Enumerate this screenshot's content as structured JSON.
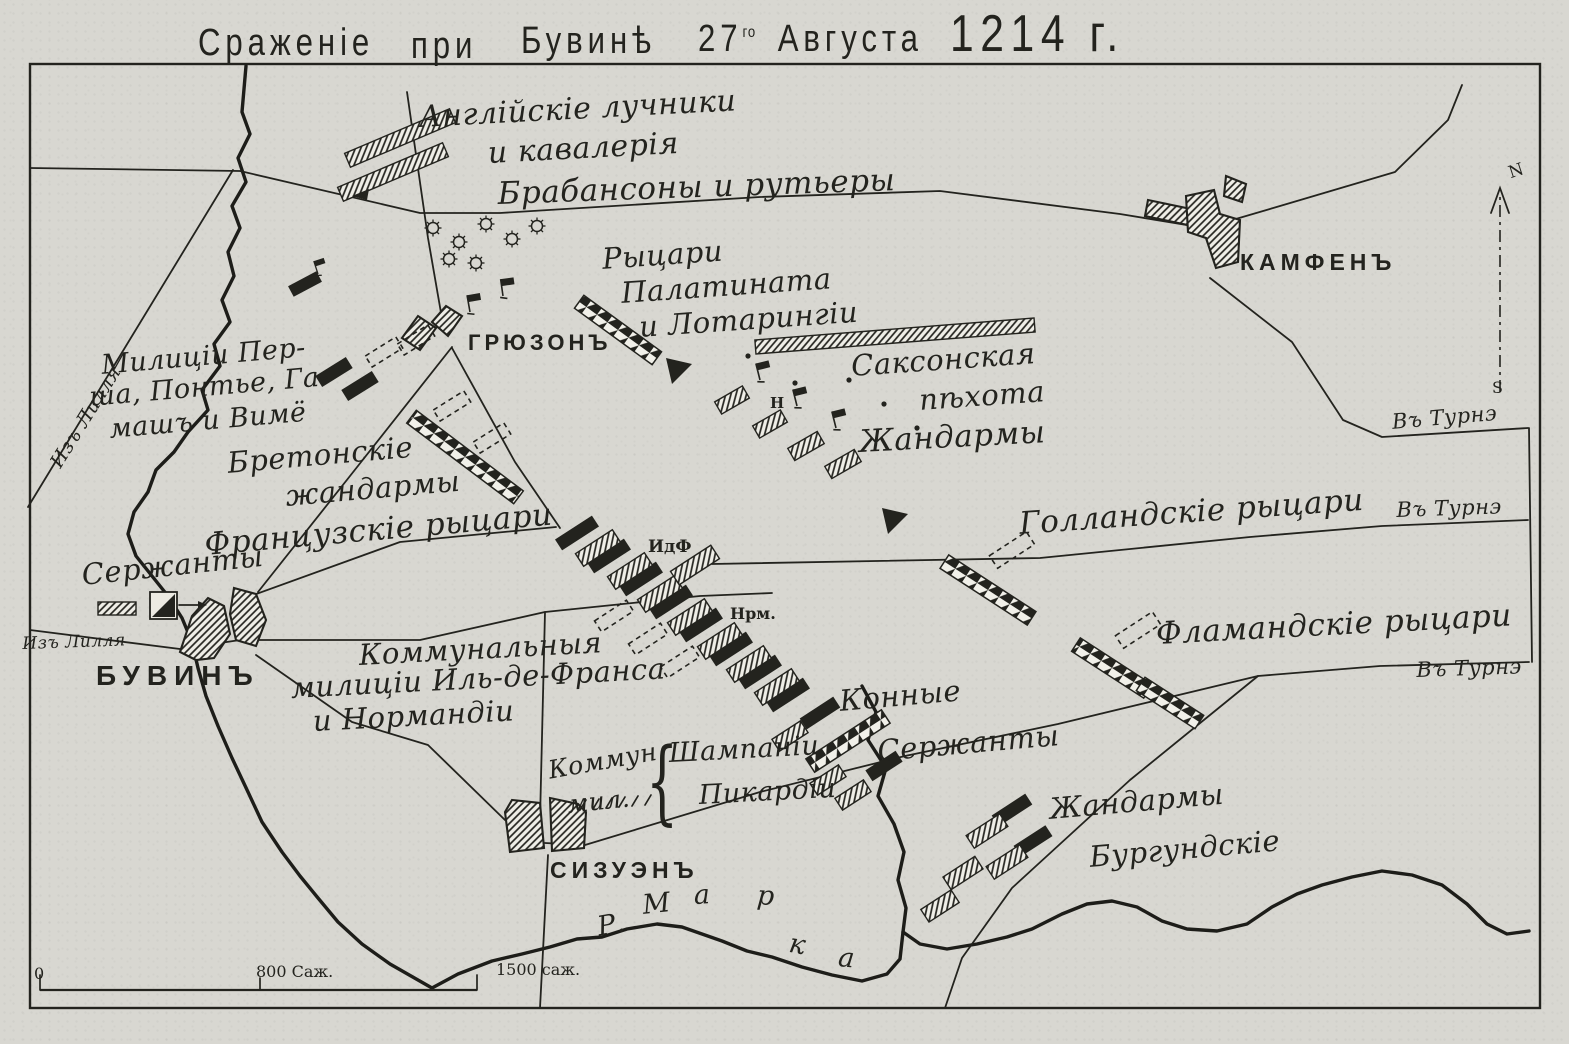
{
  "colors": {
    "paper": "#d8d7d1",
    "ink": "#23231e"
  },
  "title": {
    "w1": "Сраженіе",
    "w2": "при",
    "w3": "Бувинѣ",
    "day": "27",
    "day_sup": "го",
    "month": "Августа",
    "year": "1214 г."
  },
  "places": {
    "gruzon": "ГРЮЗОНЪ",
    "bouvines": "БУВИНЪ",
    "cysoing": "СИЗУЭНЪ",
    "kamphin": "КАМФЕНЪ"
  },
  "forces": {
    "english_line1": "Англійскіе лучники",
    "english_line2": "и кавалерія",
    "brabancons": "Брабансоны и рутьеры",
    "palatinate_line1": "Рыцари",
    "palatinate_line2": "Палатината",
    "palatinate_line3": "и Лотарингіи",
    "saxon_line1": "Саксонская",
    "saxon_line2": "пѣхота",
    "gendarmes": "Жандармы",
    "militia_line1": "Милиціи Пер-",
    "militia_line2": "ша, Понтье, Га-",
    "militia_line3": "машъ и Вимё",
    "breton_line1": "Бретонскіе",
    "breton_line2": "жандармы",
    "french_knights": "Французскіе рыцари",
    "sergeants": "Сержанты",
    "communal_line1": "Коммунальныя",
    "communal_line2": "милиціи Иль-де-Франса",
    "communal_line3": "и Нормандіи",
    "idf": "ИдФ",
    "nrm": "Нрм.",
    "n_mark": "Н",
    "dutch_knights": "Голландскіе рыцари",
    "flemish_knights": "Фламандскіе рыцари",
    "mounted_line1": "Конные",
    "mounted_line2": "Сержанты",
    "commun_line1": "Коммун.",
    "commun_line2": "мил.",
    "brace": "{",
    "champagne": "Шампаніи",
    "picardy": "Пикардіи",
    "burgundy_line1": "Жандармы",
    "burgundy_line2": "Бургундскіе"
  },
  "roads": {
    "to_tournai_1": "Въ Турнэ",
    "to_tournai_2": "Въ Турнэ",
    "to_tournai_3": "Въ Турнэ",
    "from_lille_north": "Изъ Лилля",
    "from_lille_west": "Изъ Лилля"
  },
  "river": {
    "l1": "Р.",
    "l2": "М",
    "l3": "а",
    "l4": "р",
    "l5": "к",
    "l6": "а"
  },
  "scale": {
    "zero": "0",
    "mid": "800 Саж.",
    "end": "1500 саж."
  },
  "compass": {
    "north": "N",
    "south": "S"
  }
}
